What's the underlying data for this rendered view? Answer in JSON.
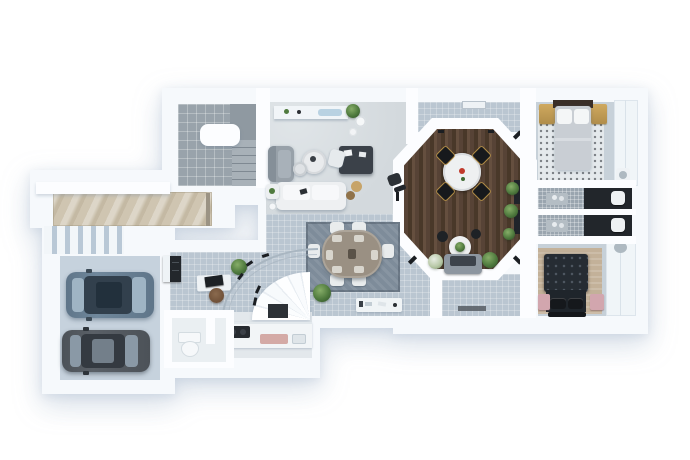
{
  "meta": {
    "description": "3D rendered residential floor plan, top-down view, no visible text"
  },
  "colors": {
    "background": "#ffffff",
    "wall": "#f6f9fc",
    "wall_bright": "#fcfdff",
    "floor_tile": "#bac6d1",
    "stair_tile": "#99a3ab",
    "living_floor": "#d3d9dd",
    "kitchen_floor": "#e3e8ec",
    "octagon_wood_1": "#574336",
    "octagon_wood_2": "#493829",
    "octagon_wood_3": "#654f3f",
    "marble": "#cfc5b1",
    "garage_floor": "#c6d2dd",
    "car1_body": "#5f7589",
    "car1_roof": "#32404d",
    "car2_body": "#4c5258",
    "car2_roof": "#343a41",
    "glassline": "#a9b6c1",
    "rug_dining": "#7e8c9a",
    "table_taupe": "#9a9083",
    "chair_white": "#e9eced",
    "sofa_white": "#eef0f2",
    "armchair_gray": "#98a1a9",
    "desk_dark": "#3b4149",
    "plant": "#4f7a3e",
    "plant_dark": "#35592c",
    "gold": "#b08d4a",
    "gold_light": "#cfa95f",
    "rug_dots": "#e4e9ec",
    "bed1_blanket": "#c9ced4",
    "bed2_tufted": "#262c33",
    "bed2_body": "#1f252b",
    "pink": "#d2a6ae",
    "rug_tan": "#c3b199",
    "slab_dark": "#22262b",
    "mosaic": "#9aa5af",
    "console_white": "#f0f4f6",
    "black": "#1b1e22",
    "red_accent": "#c0392b",
    "blue_tray": "#b9d2e2",
    "brown_chair": "#6f5038"
  },
  "scene": {
    "type": "floor-plan-render",
    "view": "top-down",
    "rooms": [
      {
        "id": "garage",
        "contents": [
          "blue-gray-suv",
          "dark-gray-sedan",
          "slatted-gate"
        ]
      },
      {
        "id": "stair-room",
        "contents": [
          "tiled-floor",
          "winder-stairs",
          "white-landing"
        ]
      },
      {
        "id": "entry-walkway",
        "contents": [
          "marble-path",
          "white-ledge",
          "front-door"
        ]
      },
      {
        "id": "living-room",
        "contents": [
          "white-sofa",
          "gray-armchair",
          "round-coffee-tables",
          "wall-shelf",
          "dark-desk",
          "white-chair",
          "plants",
          "poufs"
        ]
      },
      {
        "id": "dining-area",
        "contents": [
          "oval-table",
          "six-white-chairs",
          "blue-gray-rug",
          "media-console",
          "plant"
        ]
      },
      {
        "id": "home-office",
        "contents": [
          "desk-with-monitor",
          "brown-chair",
          "dark-cabinet",
          "plant",
          "curved-glass-wall",
          "fan-stair-feature"
        ]
      },
      {
        "id": "kitchen",
        "contents": [
          "counter",
          "dark-cooktop",
          "pink-board",
          "sink"
        ]
      },
      {
        "id": "powder-room",
        "contents": [
          "toilet"
        ]
      },
      {
        "id": "octagon-lounge",
        "contents": [
          "dark-wood-floor",
          "round-table",
          "four-black-chairs",
          "small-plant-table",
          "stools",
          "gray-sofa",
          "plants",
          "spotlights",
          "window-benches"
        ]
      },
      {
        "id": "bedroom-top-right",
        "contents": [
          "light-bed",
          "white-pillows",
          "gold-nightstands",
          "dotted-rug",
          "wardrobe"
        ]
      },
      {
        "id": "bathroom-upper",
        "contents": [
          "mosaic-floor",
          "dark-vanity",
          "toilet",
          "chrome-fixtures"
        ]
      },
      {
        "id": "bathroom-lower",
        "contents": [
          "mosaic-floor",
          "dark-vanity",
          "toilet",
          "chrome-fixtures"
        ]
      },
      {
        "id": "bedroom-bottom-right",
        "contents": [
          "dark-tufted-bed",
          "black-pillows",
          "pink-nightstands",
          "tan-rug",
          "foot-bench",
          "closet",
          "wall-basin"
        ]
      }
    ]
  }
}
